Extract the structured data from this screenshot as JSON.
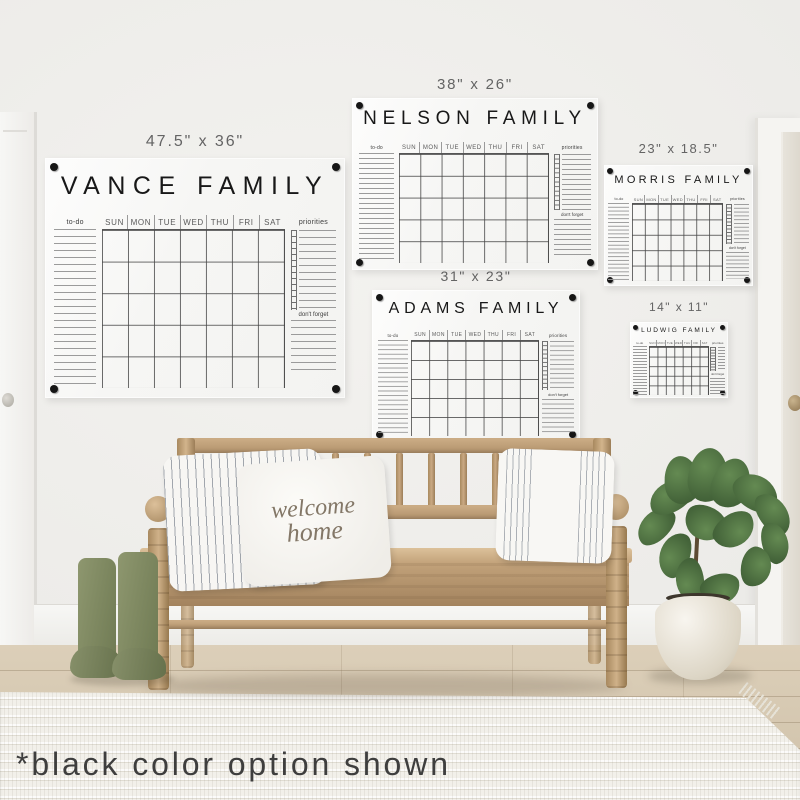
{
  "scene": {
    "annotation": "*black color option shown",
    "pillow": {
      "line1": "welcome",
      "line2": "home"
    }
  },
  "boards": [
    {
      "name": "vance",
      "size_label": "47.5\" x 36\"",
      "title": "VANCE FAMILY",
      "todo_label": "to-do",
      "days": [
        "SUN",
        "MON",
        "TUE",
        "WED",
        "THU",
        "FRI",
        "SAT"
      ],
      "priorities_label": "priorities",
      "dont_forget_label": "don't forget"
    },
    {
      "name": "nelson",
      "size_label": "38\" x 26\"",
      "title": "NELSON FAMILY",
      "todo_label": "to-do",
      "days": [
        "SUN",
        "MON",
        "TUE",
        "WED",
        "THU",
        "FRI",
        "SAT"
      ],
      "priorities_label": "priorities",
      "dont_forget_label": "don't forget"
    },
    {
      "name": "morris",
      "size_label": "23\" x 18.5\"",
      "title": "MORRIS FAMILY",
      "todo_label": "to-do",
      "days": [
        "SUN",
        "MON",
        "TUE",
        "WED",
        "THU",
        "FRI",
        "SAT"
      ],
      "priorities_label": "priorities",
      "dont_forget_label": "don't forget"
    },
    {
      "name": "adams",
      "size_label": "31\" x 23\"",
      "title": "ADAMS FAMILY",
      "todo_label": "to-do",
      "days": [
        "SUN",
        "MON",
        "TUE",
        "WED",
        "THU",
        "FRI",
        "SAT"
      ],
      "priorities_label": "priorities",
      "dont_forget_label": "don't forget"
    },
    {
      "name": "ludwig",
      "size_label": "14\" x 11\"",
      "title": "LUDWIG FAMILY",
      "todo_label": "to-do",
      "days": [
        "SUN",
        "MON",
        "TUE",
        "WED",
        "THU",
        "FRI",
        "SAT"
      ],
      "priorities_label": "priorities",
      "dont_forget_label": "don't forget"
    }
  ],
  "colors": {
    "option_color_shown": "#161616",
    "wood": "#bd9f7c",
    "boots_green": "#7f8a62",
    "leaf_green": "#4a6a3d"
  }
}
